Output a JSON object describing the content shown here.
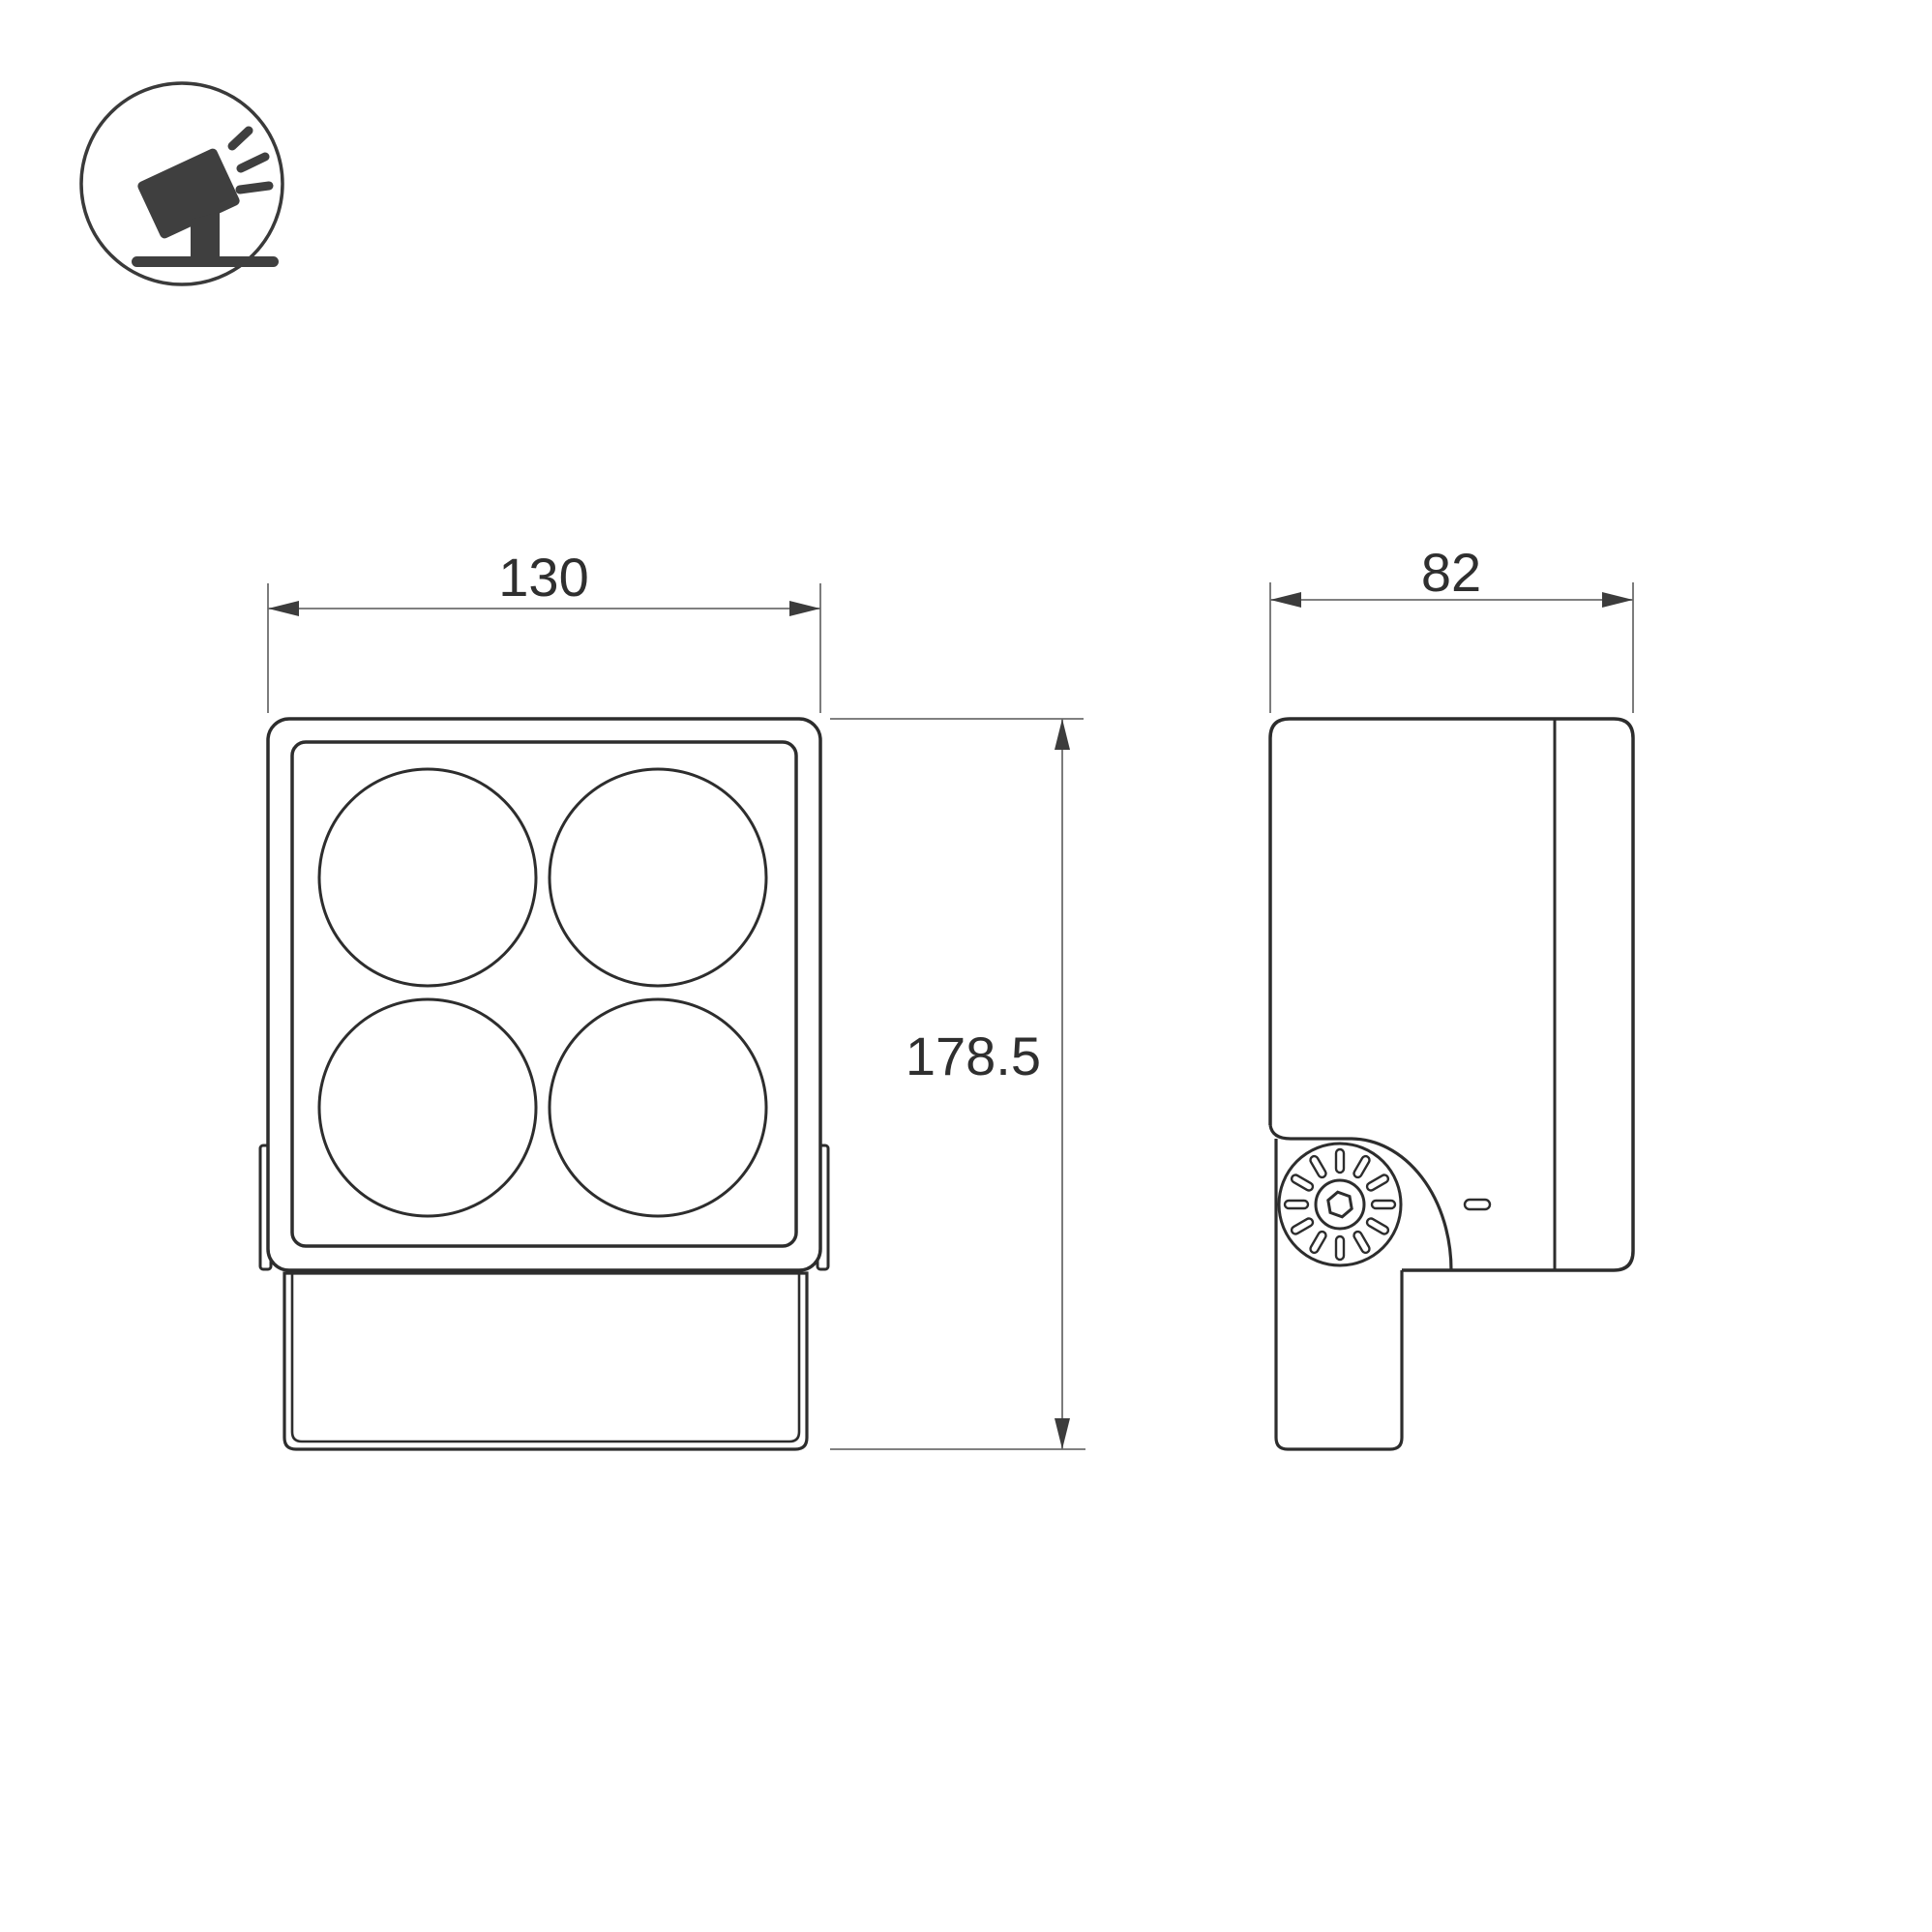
{
  "background": "#ffffff",
  "colors": {
    "outline": "#2d2d2d",
    "dimension_line": "#6e6e6e",
    "arrowhead": "#3c3c3c",
    "label_text": "#2f2f2f",
    "icon": "#3f3f3f"
  },
  "logo": {
    "name": "tilted-floodlight-badge"
  },
  "front_view": {
    "lens_count": 4,
    "width_dimension": {
      "label": "130"
    },
    "height_dimension": {
      "label": "178.5"
    }
  },
  "side_view": {
    "depth_dimension": {
      "label": "82"
    }
  }
}
